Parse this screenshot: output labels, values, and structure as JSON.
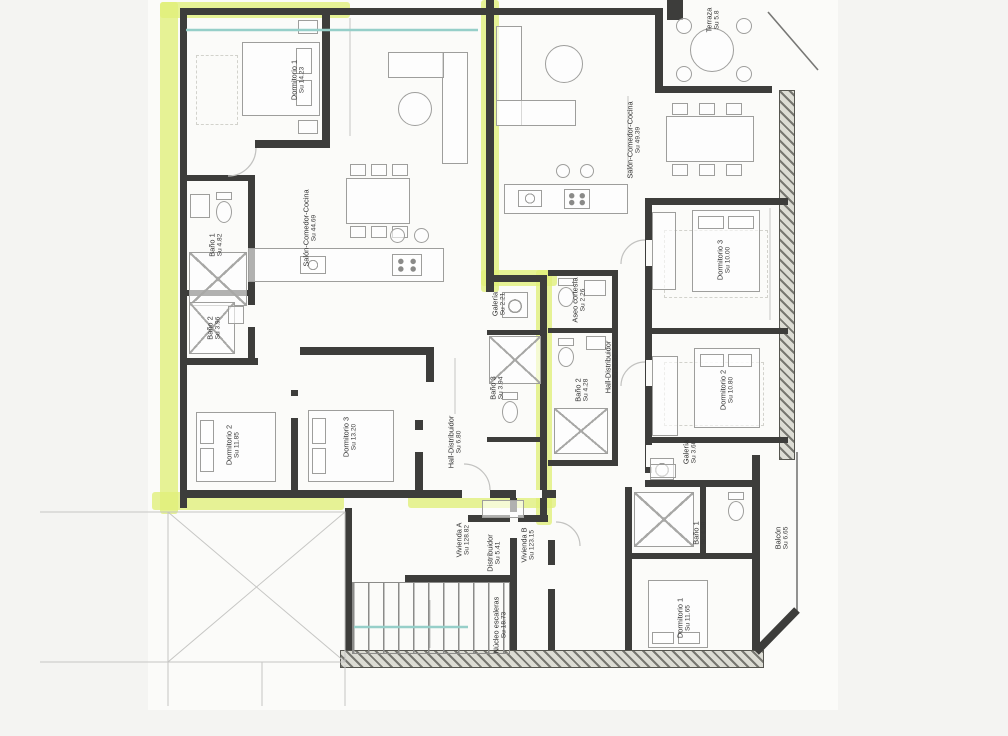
{
  "plan": {
    "vivienda_a": {
      "unit_label": {
        "name": "Vivienda A",
        "area": "Su 128.82"
      },
      "rooms": {
        "dormitorio_1": {
          "name": "Dormitorio 1",
          "area": "Su 14.23"
        },
        "bano_1": {
          "name": "Baño 1",
          "area": "Su 4.82"
        },
        "bano_2": {
          "name": "Baño 2",
          "area": "Su 3.96"
        },
        "salon_comedor_cocina": {
          "name": "Salón-Comedor-Cocina",
          "area": "Su 44.69"
        },
        "dormitorio_2": {
          "name": "Dormitorio 2",
          "area": "Su 11.85"
        },
        "dormitorio_3": {
          "name": "Dormitorio 3",
          "area": "Su 13.20"
        },
        "hall_distribuidor": {
          "name": "Hall-Distribuidor",
          "area": "Su 6.80"
        },
        "galeria": {
          "name": "Galería",
          "area": "Su 2.21"
        },
        "bano_3": {
          "name": "Baño 3",
          "area": "Su 3.94"
        }
      }
    },
    "vivienda_b": {
      "unit_label": {
        "name": "Vivienda B",
        "area": "Su 123.15"
      },
      "rooms": {
        "terraza": {
          "name": "Terraza",
          "area": "Su 5.8"
        },
        "salon_comedor_cocina": {
          "name": "Salón-Comedor-Cocina",
          "area": "Su 49.39"
        },
        "dormitorio_3": {
          "name": "Dormitorio 3",
          "area": "Su 10.00"
        },
        "dormitorio_2": {
          "name": "Dormitorio 2",
          "area": "Su 10.80"
        },
        "galeria": {
          "name": "Galería",
          "area": "Su 3.60"
        },
        "hall_distribuidor": {
          "name": "Hall-Distribuidor",
          "area": "Su 11.32"
        },
        "aseo_cortesia": {
          "name": "Aseo cortesía",
          "area": "Su 2.26"
        },
        "bano_2": {
          "name": "Baño 2",
          "area": "Su 4.28"
        },
        "bano_1": {
          "name": "Baño 1",
          "area": "Su 4.38"
        },
        "dormitorio_1": {
          "name": "Dormitorio 1",
          "area": "Su 11.65"
        },
        "balcon": {
          "name": "Balcón",
          "area": "Su 6.65"
        }
      }
    },
    "common": {
      "distribuidor": {
        "name": "Distribuidor",
        "area": "Su 5.41"
      },
      "nucleo_escaleras": {
        "name": "Núcleo escaleras",
        "area": "Su 18.73"
      }
    },
    "colors": {
      "highlight": "#e0f078",
      "wall": "#3d3d3b",
      "teal": "#96cfc9"
    }
  }
}
